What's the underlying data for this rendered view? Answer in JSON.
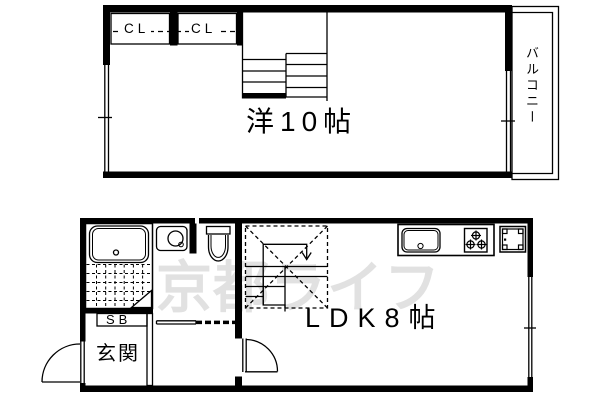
{
  "floorplan": {
    "upper_floor": {
      "room_label": "洋10帖",
      "balcony_label": "バルコニー",
      "closet_labels": [
        "CL",
        "CL"
      ]
    },
    "lower_floor": {
      "room_label": "LDK8帖",
      "entrance_label": "玄関",
      "shoebox_label": "SB"
    },
    "watermark": "京都ライフ",
    "colors": {
      "line": "#000000",
      "watermark": "#e1e1e1",
      "background": "#ffffff"
    }
  }
}
